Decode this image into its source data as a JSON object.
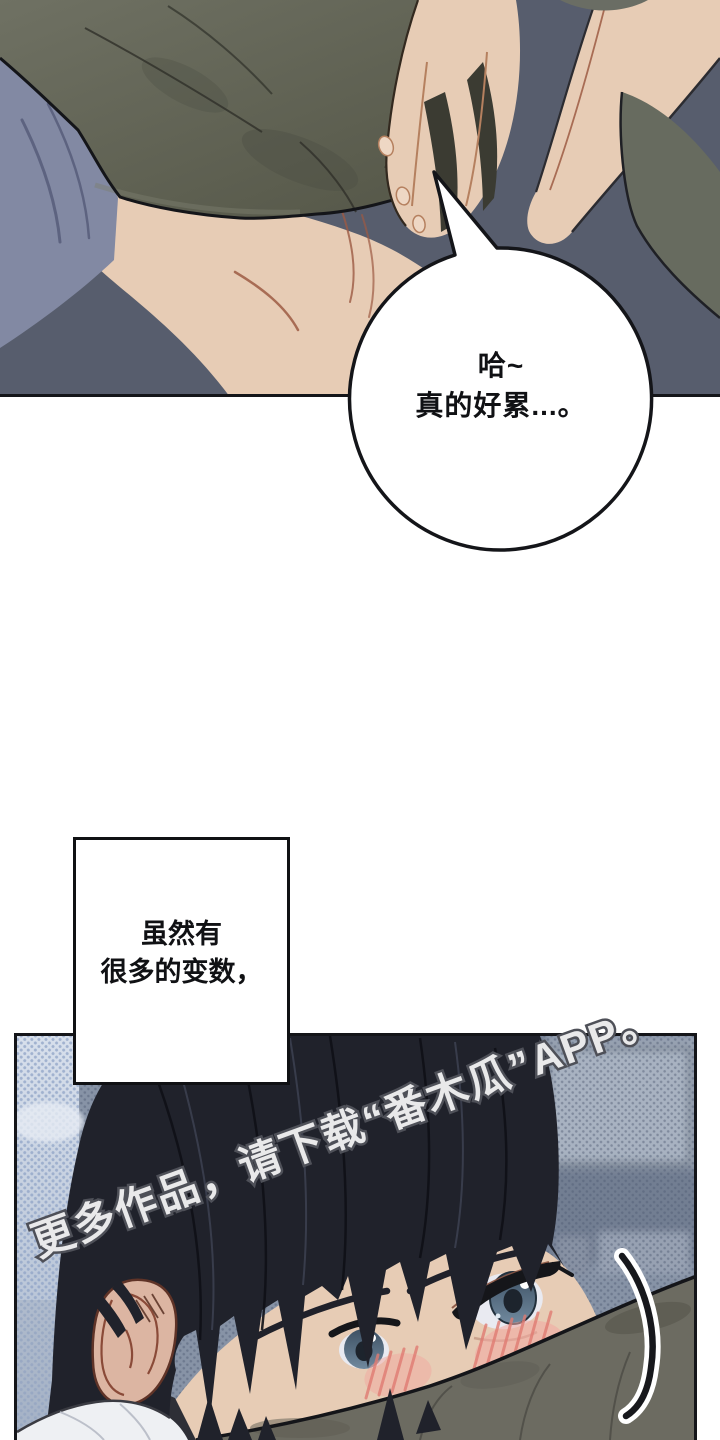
{
  "page": {
    "type": "webtoon-comic-page",
    "background": "#ffffff",
    "width": 720,
    "height": 1440
  },
  "speech_bubble": {
    "alt": "round speech bubble pointing to resting person",
    "lines": [
      "哈~",
      "真的好累...。"
    ]
  },
  "caption_box": {
    "alt": "rectangular narration box",
    "lines": [
      "虽然有",
      "很多的变数，"
    ]
  },
  "watermark": {
    "text": "更多作品，请下载“番木瓜”APP。"
  },
  "top_panel": {
    "alt": "person lying face down hugging an olive pillow, bare shoulder and arm visible on slate background"
  },
  "bottom_panel": {
    "alt": "dark-haired boy peeking over a pillow with blushing cheeks and blue-grey eyes, blurred halftone room background",
    "icons": [
      "motion-swoosh-icon"
    ]
  },
  "palette": {
    "ink": "#141519",
    "white": "#ffffff",
    "slate": "#575d6d",
    "pillow_hi": "#6f7163",
    "pillow_lo": "#555748",
    "pillow_line": "#2f3029",
    "fabric": "#8289a3",
    "fabric_shadow": "#5d6380",
    "skin": "#e7ccb5",
    "skin_line": "#9c5a43",
    "wedge": "#676b5f",
    "bbg": "#8793a6",
    "bbg_light": "#a8b2c1",
    "bbg_dark": "#727e92",
    "dot_dark": "#4e5a72",
    "band_hi": "#d8e0ec",
    "band_lo": "#aab8cd",
    "dot_light": "#8fa3c6",
    "hair": "#20222b",
    "hair_line": "#0f1016",
    "hair_sheen": "#3e4354",
    "brow": "#20212a",
    "sclera": "#e9eaf1",
    "iris_hi": "#70899e",
    "iris_lo": "#3d5063",
    "blush": "#f2a8a0",
    "blush_line": "#e07b72",
    "ear": "#dcb5a2",
    "ear_line": "#8a4a38",
    "shirt": "#eef0f3",
    "pillow2": "#6c6b61",
    "wm_fill": "#e9e9ea",
    "wm_stroke": "#4e5058"
  }
}
